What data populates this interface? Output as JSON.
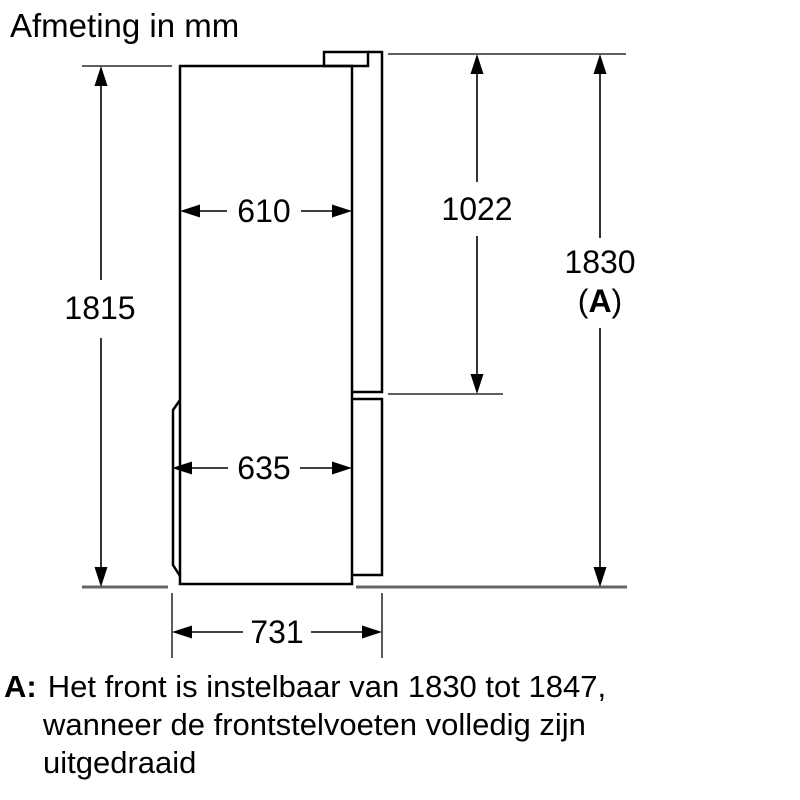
{
  "title": "Afmeting in mm",
  "unit": "mm",
  "dims": {
    "body_height": "1815",
    "cabinet_depth": "610",
    "upper_door_height": "1022",
    "total_height": "1830",
    "total_height_ref_open": "(",
    "total_height_ref": "A",
    "total_height_ref_close": ")",
    "depth_without_door": "635",
    "total_depth": "731"
  },
  "footnote": {
    "marker": "A:",
    "lines": [
      "Het front is instelbaar van 1830 tot 1847,",
      "wanneer de frontstelvoeten volledig zijn",
      "uitgedraaid"
    ]
  },
  "colors": {
    "line": "#000000",
    "floor": "#666666",
    "background": "#ffffff"
  }
}
